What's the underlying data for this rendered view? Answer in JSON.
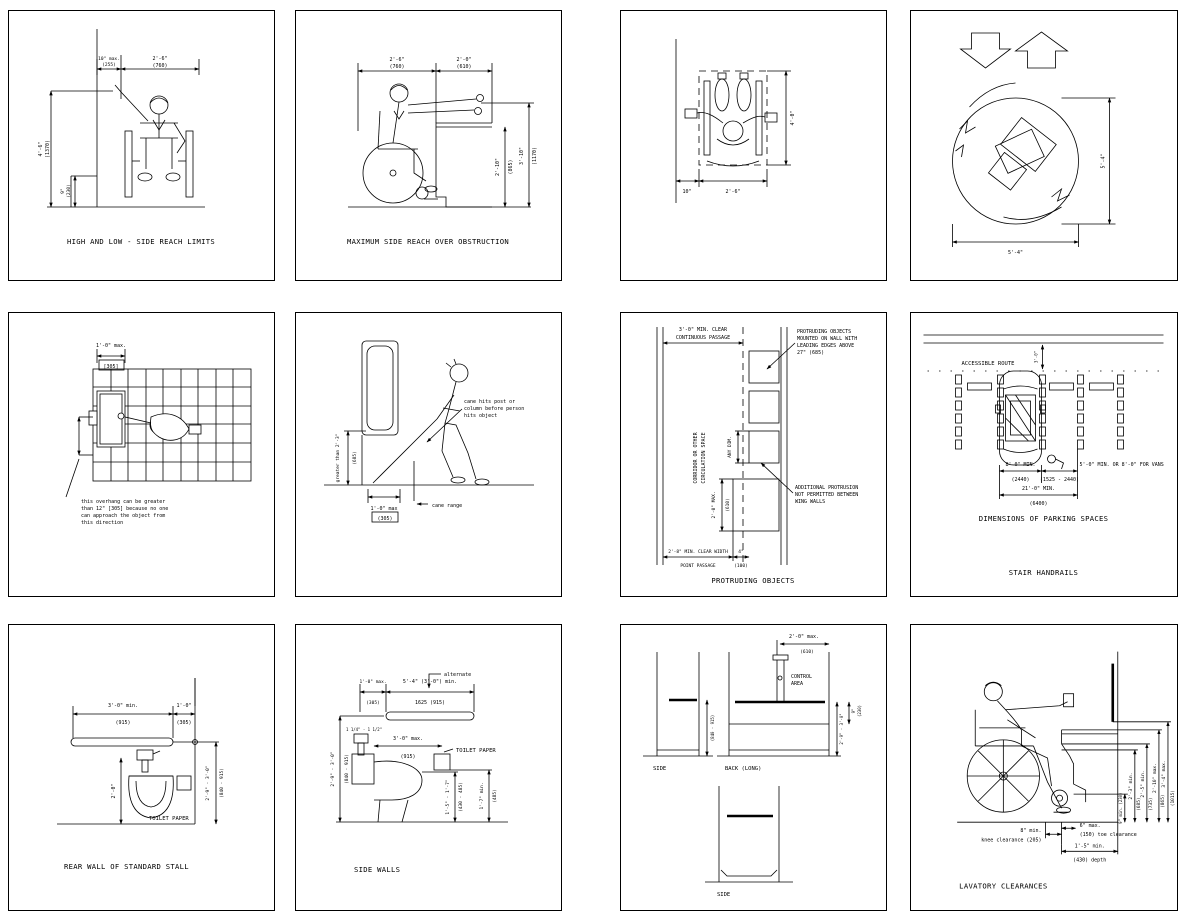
{
  "page": {
    "bg": "#ffffff",
    "line_color": "#000000"
  },
  "panels": {
    "reach_limits": {
      "caption": "HIGH AND LOW - SIDE REACH LIMITS",
      "dim_wall_offset": "10\" max.",
      "dim_wall_offset_mm": "(255)",
      "dim_width": "2'-6\"",
      "dim_width_mm": "(760)",
      "dim_high": "4'-6\"",
      "dim_high_mm": "(1370)",
      "dim_low": "9\"",
      "dim_low_mm": "(230)"
    },
    "side_reach": {
      "caption": "MAXIMUM SIDE REACH OVER OBSTRUCTION",
      "dim_clear": "2'-6\"",
      "dim_clear_mm": "(760)",
      "dim_obstruction": "2'-0\"",
      "dim_obstruction_mm": "(610)",
      "dim_reach": "3'-10\"",
      "dim_reach_mm": "(1170)",
      "dim_counter": "2'-10\"",
      "dim_counter_mm": "(865)"
    },
    "clear_floor_space": {
      "dim_offset": "10\"",
      "dim_width": "2'-6\"",
      "dim_length": "4'-0\""
    },
    "turning_space": {
      "dim_dia_v": "5'-4\"",
      "dim_dia_h": "5'-4\""
    },
    "overhang": {
      "dim_max": "1'-0\" max.",
      "dim_max_mm": "[305]",
      "note": [
        "this overhang can be greater",
        "than 12\" [305] because no one",
        "can approach the object from",
        "this direction"
      ]
    },
    "cane_range": {
      "note": [
        "cane hits post or",
        "column before person",
        "hits object"
      ],
      "dim_height": "greater than 2'-3\"",
      "dim_height_mm": "(685)",
      "dim_depth": "1'-0\" max",
      "dim_depth_mm": "(305)",
      "label": "cane range"
    },
    "protruding": {
      "caption": "PROTRUDING OBJECTS",
      "dim_passage": "3'-0\" MIN. CLEAR",
      "dim_passage2": "CONTINUOUS PASSAGE",
      "corridor1": "CORRIDOR OR OTHER",
      "corridor2": "CIRCULATION SPACE",
      "dim_any": "ANY DIM.",
      "dim_protrusion": "2'-0\" MAX.",
      "dim_protrusion_mm": "(610)",
      "note1": [
        "PROTRUDING OBJECTS",
        "MOUNTED ON WALL WITH",
        "LEADING EDGES ABOVE",
        "27\" (685)"
      ],
      "note2": [
        "ADDITIONAL PROTRUSION",
        "NOT PERMITTED BETWEEN",
        "WING WALLS"
      ],
      "dim_point": "2'-8\" MIN. CLEAR WIDTH",
      "dim_point2": "POINT PASSAGE",
      "dim_gap": "4\"",
      "dim_gap_mm": "(100)"
    },
    "parking": {
      "caption": "DIMENSIONS OF PARKING SPACES",
      "caption2": "STAIR HANDRAILS",
      "route_label": "ACCESSIBLE ROUTE",
      "dim_route": "3'-0\"",
      "dim_space": "8'-0\" MIN.",
      "dim_space_mm": "(2440)",
      "dim_aisle": "5'-0\" MIN. OR 8'-0\" FOR VANS",
      "dim_aisle_mm": "(1525 - 2440)",
      "dim_total": "21'-0\" MIN.",
      "dim_total_mm": "(6400)"
    },
    "rear_wall": {
      "caption": "REAR WALL OF STANDARD STALL",
      "dim_bar": "3'-0\" min.",
      "dim_bar_mm": "(915)",
      "dim_wall": "1'-0\"",
      "dim_wall_mm": "(305)",
      "dim_valve": "2'-0\"",
      "dim_height": "2'-9\" - 3'-0\"",
      "dim_height_mm": "(840 - 915)",
      "tp_label": "TOILET PAPER"
    },
    "side_walls": {
      "caption": "SIDE WALLS",
      "alternate": "alternate",
      "dim_rear": "1'-0\" max.",
      "dim_rear_mm": "(305)",
      "dim_bar": "5'-4\" (3'-0\") min.",
      "dim_bar_mm": "1625 (915)",
      "dim_height": "2'-9\" - 3'-0\"",
      "dim_height_mm": "(840 - 915)",
      "dim_dia": "1 1/4\" - 1 1/2\"",
      "dim_tp": "3'-0\" max.",
      "dim_tp_mm": "(915)",
      "tp_label": "TOILET PAPER",
      "dim_seat": "1'-5\" - 1'-7\"",
      "dim_seat_mm": "(430 - 485)",
      "dim_tp_h": "1'-7\" min.",
      "dim_tp_h_mm": "(485)"
    },
    "tub": {
      "cap_side1": "SIDE",
      "cap_back": "BACK (LONG)",
      "cap_side2": "SIDE",
      "control1": "CONTROL",
      "control2": "AREA",
      "dim_control": "2'-0\" max.",
      "dim_control_mm": "(610)",
      "dim_bar_h": "2'-9\" - 3'-0\"",
      "dim_bar_h_mm": "(840 - 915)",
      "dim_rim": "9\"",
      "dim_rim_mm": "(230)"
    },
    "lavatory": {
      "caption": "LAVATORY CLEARANCES",
      "dim_toe_h": "9\" min. (230)",
      "dim_knee_h": "2'-3\" min.",
      "dim_knee_h_mm": "(685)",
      "dim_apron": "2'-5\" min.",
      "dim_apron_mm": "(735)",
      "dim_rim": "2'-10\" max.",
      "dim_rim_mm": "(865)",
      "dim_mirror": "3'-4\" max.",
      "dim_mirror_mm": "(1015)",
      "dim_knee_d": "8\" min.",
      "dim_knee_d2": "knee clearance (205)",
      "dim_toe_d": "6\" max.",
      "dim_toe_d2": "(150) toe clearance",
      "dim_depth": "1'-5\" min.",
      "dim_depth2": "(430) depth"
    }
  }
}
